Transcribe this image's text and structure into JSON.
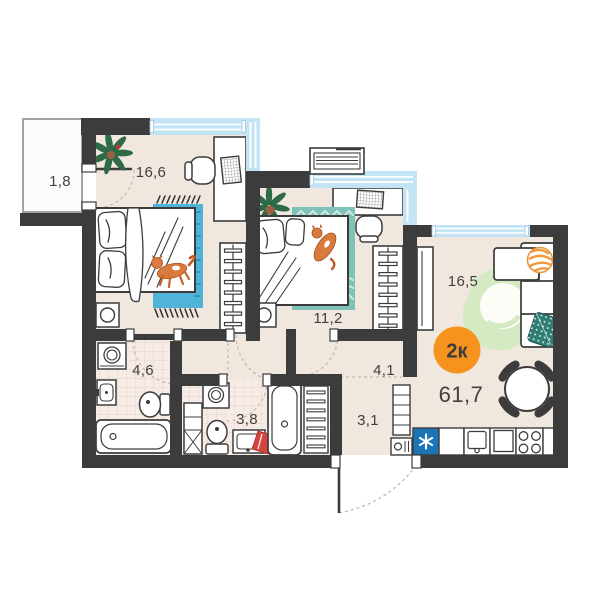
{
  "plan": {
    "badge": {
      "label": "2к"
    },
    "total_area_label": "61,7",
    "rooms": {
      "balcony": {
        "area": "1,8"
      },
      "bedroom_main": {
        "area": "16,6"
      },
      "bedroom_second": {
        "area": "11,2"
      },
      "living_kitchen": {
        "area": "16,5"
      },
      "bathroom": {
        "area": "4,6"
      },
      "bathroom_small": {
        "area": "3,8"
      },
      "hallway": {
        "area": "4,1"
      },
      "entry": {
        "area": "3,1"
      }
    },
    "icons": [
      "plant-icon",
      "cat-icon",
      "bed-icon",
      "wardrobe-icon",
      "desk-icon",
      "monitor-icon",
      "ac-unit-icon",
      "washing-machine-icon",
      "toilet-icon",
      "bathtub-icon",
      "sink-icon",
      "towel-rail-icon",
      "sofa-icon",
      "dining-table-icon",
      "stove-icon",
      "kitchen-sink-icon",
      "asterisk-appliance-icon"
    ],
    "colors": {
      "wall": "#3c3c3c",
      "floor": "#f0e7de",
      "tile_floor": "#f6ece5",
      "tile_grid": "#e4d4ca",
      "window": "#c3e4f4",
      "accent_badge": "#f6921e",
      "rug_blue": "#4fb4d7",
      "rug_teal": "#7fc2b8",
      "rug_green": "#d5e9c3",
      "appliance_blue": "#1a74b6",
      "cat_orange": "#d97a3e",
      "towel_red": "#d6453d",
      "pillow_teal": "#2f7d74",
      "label_text": "#414141"
    }
  }
}
